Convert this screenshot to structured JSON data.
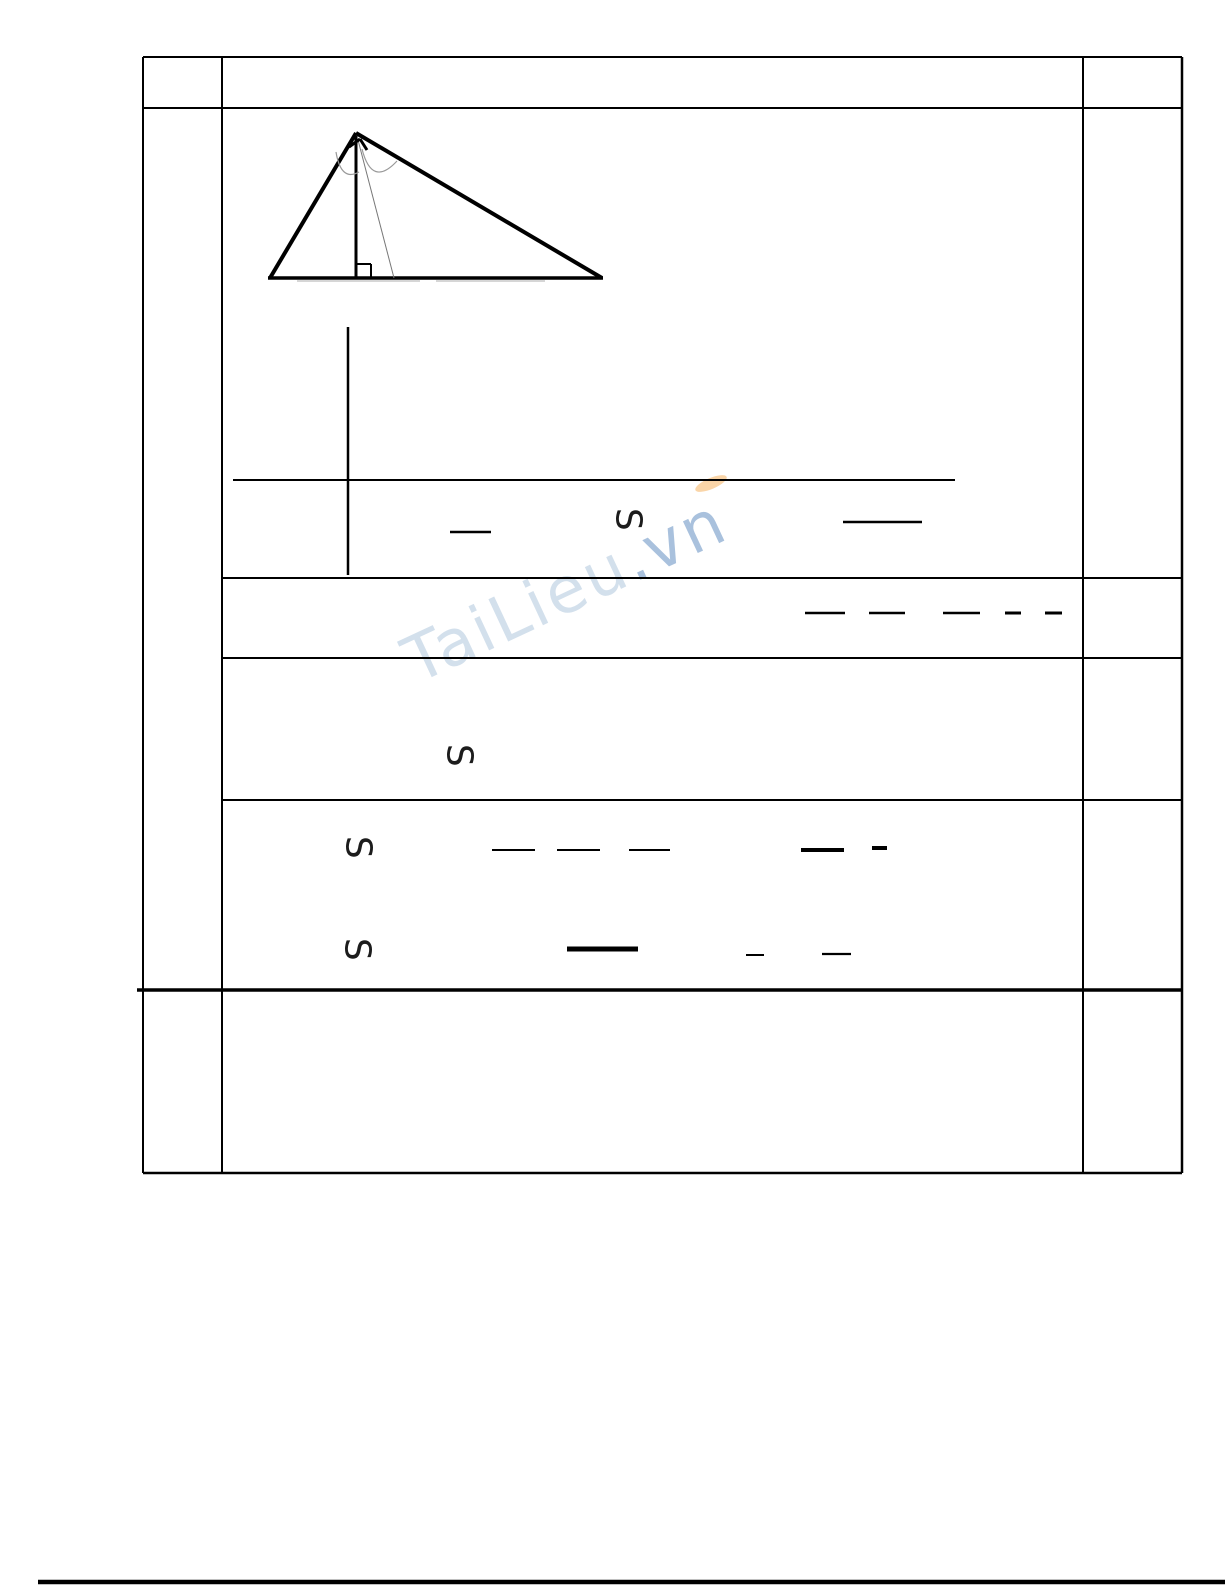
{
  "page": {
    "width": 1225,
    "height": 1585,
    "background": "#ffffff"
  },
  "watermark": {
    "text_main": "TaiLieu",
    "text_suffix": ".vn",
    "main_color": "rgba(150,180,210,0.42)",
    "suffix_color": "rgba(112,152,198,0.60)",
    "accent_color": "rgba(249,208,158,0.9)",
    "rotation_deg": -25
  },
  "area_symbols": [
    {
      "label": "S",
      "x": 628,
      "y": 521,
      "font_size": 36
    },
    {
      "label": "S",
      "x": 459,
      "y": 757,
      "font_size": 36
    },
    {
      "label": "S",
      "x": 358,
      "y": 849,
      "font_size": 36
    },
    {
      "label": "S",
      "x": 357,
      "y": 951,
      "font_size": 36
    }
  ],
  "table": {
    "lines": [
      {
        "name": "table-top-border",
        "x1": 143,
        "y1": 57,
        "x2": 1182,
        "y2": 57,
        "w": 2
      },
      {
        "name": "header-row-line",
        "x1": 143,
        "y1": 108,
        "x2": 1182,
        "y2": 108,
        "w": 2
      },
      {
        "name": "row-line-1",
        "x1": 222,
        "y1": 578,
        "x2": 1182,
        "y2": 578,
        "w": 2
      },
      {
        "name": "row-line-2",
        "x1": 222,
        "y1": 658,
        "x2": 1182,
        "y2": 658,
        "w": 2
      },
      {
        "name": "row-line-3",
        "x1": 222,
        "y1": 800,
        "x2": 1182,
        "y2": 800,
        "w": 2
      },
      {
        "name": "row-line-4-thick",
        "x1": 137,
        "y1": 990,
        "x2": 1182,
        "y2": 990,
        "w": 3.5
      },
      {
        "name": "table-bottom-border",
        "x1": 143,
        "y1": 1173,
        "x2": 1182,
        "y2": 1173,
        "w": 2.5
      },
      {
        "name": "table-left-border",
        "x1": 143,
        "y1": 57,
        "x2": 143,
        "y2": 1173,
        "w": 2
      },
      {
        "name": "column-divider-left",
        "x1": 222,
        "y1": 57,
        "x2": 222,
        "y2": 1173,
        "w": 2
      },
      {
        "name": "column-divider-right",
        "x1": 1083,
        "y1": 57,
        "x2": 1083,
        "y2": 1173,
        "w": 2
      },
      {
        "name": "table-right-border",
        "x1": 1182,
        "y1": 57,
        "x2": 1182,
        "y2": 1173,
        "w": 2.5
      }
    ]
  },
  "figure": {
    "lines": [
      {
        "name": "triangle-side-left",
        "x1": 356,
        "y1": 133,
        "x2": 270,
        "y2": 278,
        "w": 4
      },
      {
        "name": "triangle-side-right",
        "x1": 356,
        "y1": 133,
        "x2": 602,
        "y2": 278,
        "w": 4
      },
      {
        "name": "triangle-base",
        "x1": 268,
        "y1": 278,
        "x2": 603,
        "y2": 278,
        "w": 3.5
      },
      {
        "name": "altitude-line",
        "x1": 356,
        "y1": 136,
        "x2": 356,
        "y2": 279,
        "w": 3
      },
      {
        "name": "cevian-line",
        "x1": 358,
        "y1": 140,
        "x2": 394,
        "y2": 278,
        "w": 1,
        "color": "#777777"
      },
      {
        "name": "right-angle-foot-a",
        "x1": 357,
        "y1": 264,
        "x2": 371,
        "y2": 264,
        "w": 2
      },
      {
        "name": "right-angle-foot-b",
        "x1": 371,
        "y1": 264,
        "x2": 371,
        "y2": 278,
        "w": 2
      },
      {
        "name": "right-angle-apex-a",
        "x1": 349,
        "y1": 147,
        "x2": 360,
        "y2": 139,
        "w": 3
      },
      {
        "name": "right-angle-apex-b",
        "x1": 360,
        "y1": 139,
        "x2": 367,
        "y2": 150,
        "w": 3
      },
      {
        "name": "base-shadow-a",
        "x1": 297,
        "y1": 281,
        "x2": 420,
        "y2": 281,
        "w": 1.5,
        "color": "#c9c9c9"
      },
      {
        "name": "base-shadow-b",
        "x1": 436,
        "y1": 281,
        "x2": 545,
        "y2": 281,
        "w": 1.5,
        "color": "#c9c9c9"
      }
    ],
    "paths": [
      {
        "name": "angle-arc-left",
        "d": "M 336 152 Q 341 182 359 172",
        "w": 1.2,
        "color": "#999999"
      },
      {
        "name": "angle-arc-right",
        "d": "M 362 149 Q 372 188 397 161",
        "w": 1.2,
        "color": "#999999"
      }
    ]
  },
  "content_marks": {
    "bars": [
      {
        "name": "long-rule",
        "x1": 233,
        "y1": 480,
        "x2": 955,
        "y2": 480,
        "w": 2
      },
      {
        "name": "vertical-rule",
        "x1": 348,
        "y1": 327,
        "x2": 348,
        "y2": 575,
        "w": 2.5
      },
      {
        "name": "fraction-bar",
        "x1": 450,
        "y1": 532,
        "x2": 491,
        "y2": 532,
        "w": 2.5
      },
      {
        "name": "fraction-bar",
        "x1": 843,
        "y1": 522,
        "x2": 922,
        "y2": 522,
        "w": 2.5
      },
      {
        "name": "fraction-bar",
        "x1": 805,
        "y1": 613,
        "x2": 845,
        "y2": 613,
        "w": 2.5
      },
      {
        "name": "fraction-bar",
        "x1": 869,
        "y1": 613,
        "x2": 905,
        "y2": 613,
        "w": 2.5
      },
      {
        "name": "fraction-bar",
        "x1": 943,
        "y1": 613,
        "x2": 980,
        "y2": 613,
        "w": 2.5
      },
      {
        "name": "short-dash",
        "x1": 1005,
        "y1": 613,
        "x2": 1021,
        "y2": 613,
        "w": 3
      },
      {
        "name": "short-dash",
        "x1": 1045,
        "y1": 613,
        "x2": 1062,
        "y2": 613,
        "w": 3
      },
      {
        "name": "fraction-bar",
        "x1": 492,
        "y1": 850,
        "x2": 535,
        "y2": 850,
        "w": 2
      },
      {
        "name": "fraction-bar",
        "x1": 557,
        "y1": 850,
        "x2": 600,
        "y2": 850,
        "w": 2
      },
      {
        "name": "fraction-bar",
        "x1": 629,
        "y1": 850,
        "x2": 670,
        "y2": 850,
        "w": 2
      },
      {
        "name": "bold-bar",
        "x1": 801,
        "y1": 850,
        "x2": 844,
        "y2": 850,
        "w": 4
      },
      {
        "name": "bold-dash",
        "x1": 872,
        "y1": 848,
        "x2": 887,
        "y2": 848,
        "w": 4
      },
      {
        "name": "bold-bar",
        "x1": 567,
        "y1": 949,
        "x2": 638,
        "y2": 949,
        "w": 5
      },
      {
        "name": "short-dash",
        "x1": 746,
        "y1": 955,
        "x2": 764,
        "y2": 955,
        "w": 2
      },
      {
        "name": "fraction-bar",
        "x1": 822,
        "y1": 954,
        "x2": 851,
        "y2": 954,
        "w": 2.2
      }
    ]
  },
  "footer_rule": {
    "name": "page-footer-rule",
    "x1": 38,
    "y1": 1582,
    "x2": 1225,
    "y2": 1582,
    "w": 4.5
  }
}
